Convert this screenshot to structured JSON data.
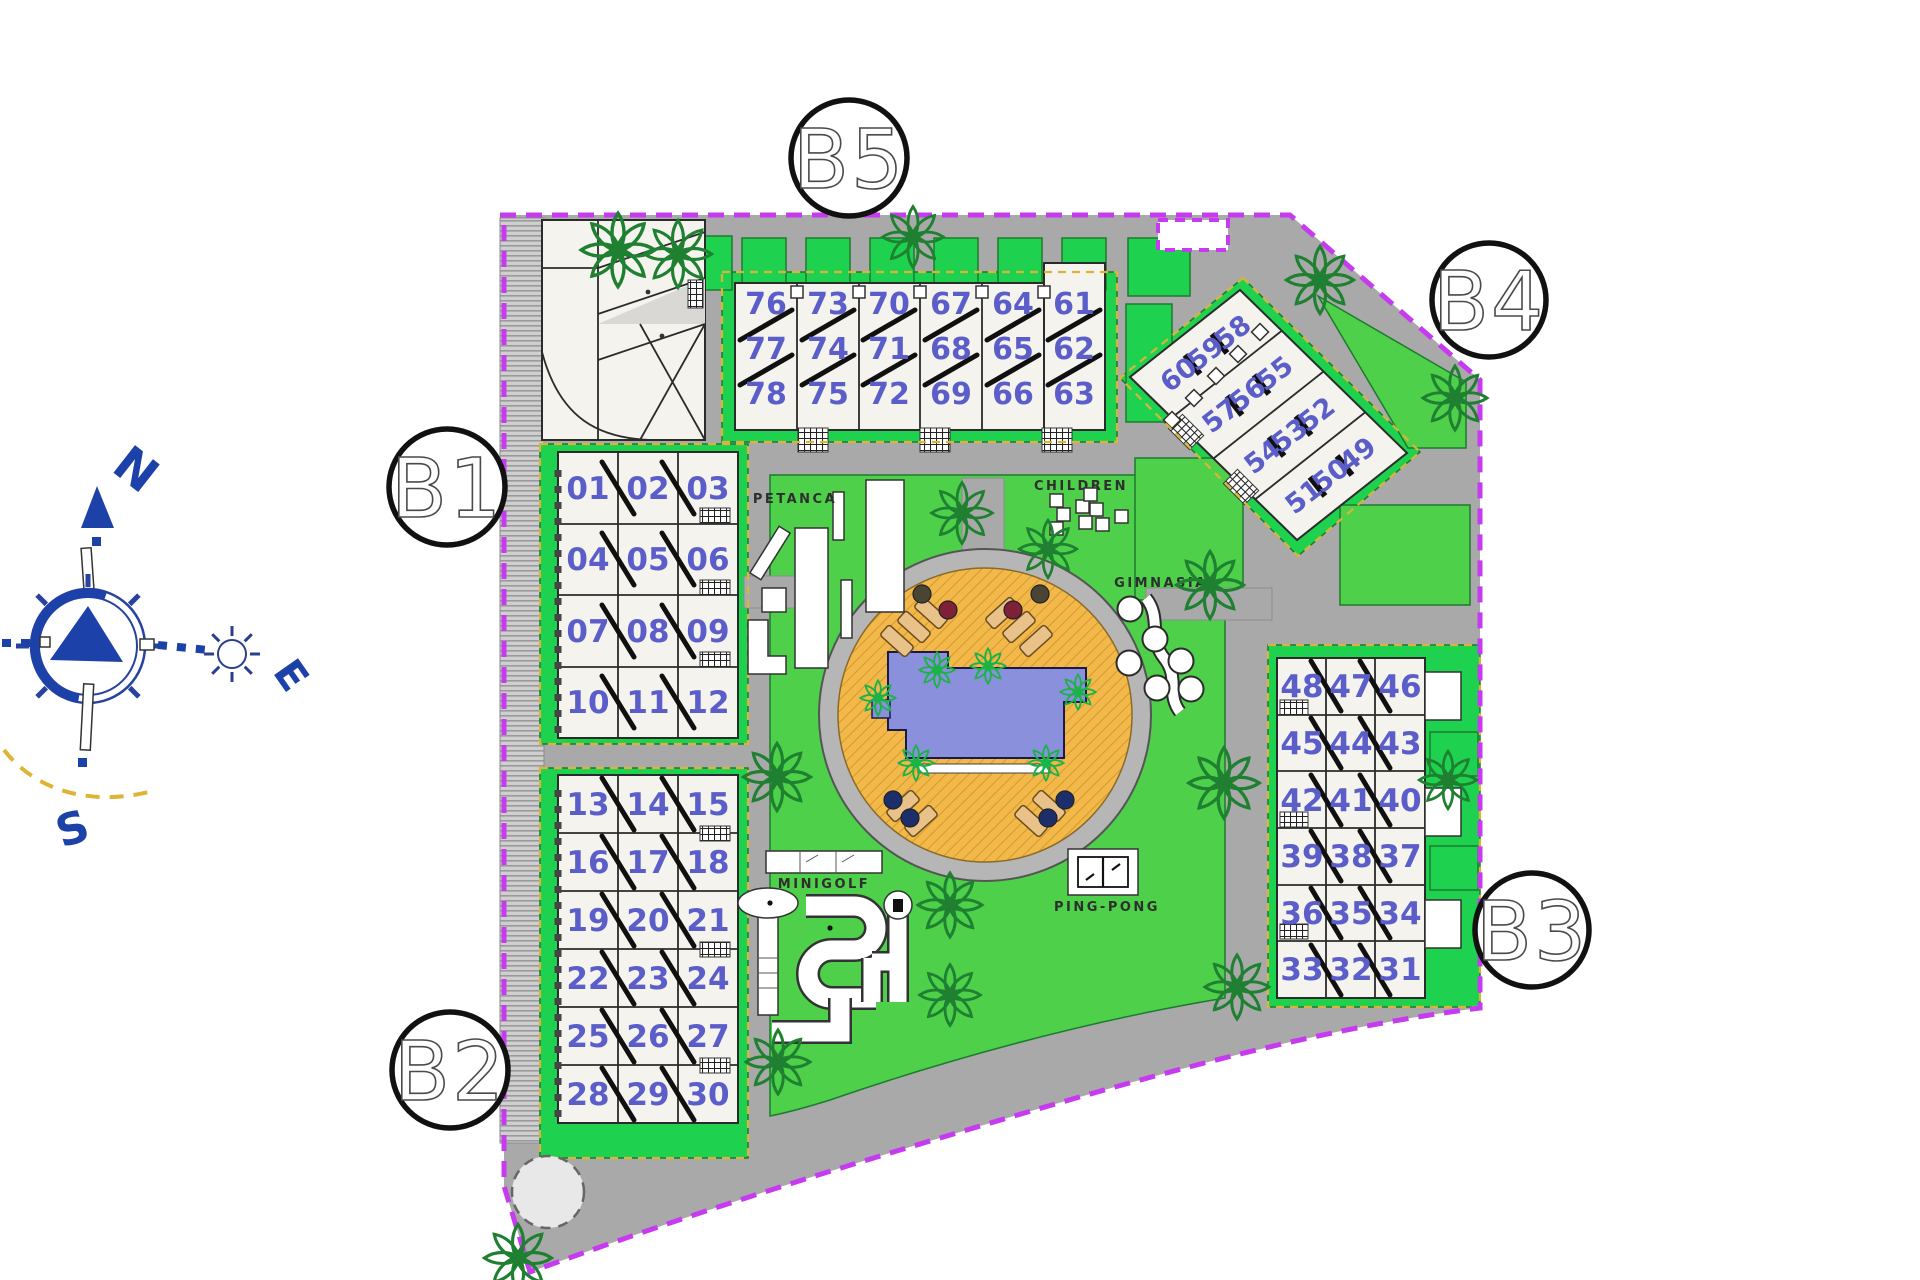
{
  "site": {
    "building_labels": {
      "b1": "B1",
      "b2": "B2",
      "b3": "B3",
      "b4": "B4",
      "b5": "B5"
    },
    "compass": {
      "north": "N",
      "east": "E",
      "south": "S"
    },
    "amenities": {
      "petanca": "PETANCA",
      "children": "CHILDREN",
      "gimnasia": "GIMNASIA",
      "minigolf": "MINIGOLF",
      "pingpong": "PING-PONG"
    },
    "buildings": {
      "b5": {
        "rows": [
          [
            "76",
            "73",
            "70",
            "67",
            "64",
            "61"
          ],
          [
            "77",
            "74",
            "71",
            "68",
            "65",
            "62"
          ],
          [
            "78",
            "75",
            "72",
            "69",
            "66",
            "63"
          ]
        ]
      },
      "b1": {
        "rows": [
          [
            "01",
            "02",
            "03"
          ],
          [
            "04",
            "05",
            "06"
          ],
          [
            "07",
            "08",
            "09"
          ],
          [
            "10",
            "11",
            "12"
          ]
        ]
      },
      "b2": {
        "rows": [
          [
            "13",
            "14",
            "15"
          ],
          [
            "16",
            "17",
            "18"
          ],
          [
            "19",
            "20",
            "21"
          ],
          [
            "22",
            "23",
            "24"
          ],
          [
            "25",
            "26",
            "27"
          ],
          [
            "28",
            "29",
            "30"
          ]
        ]
      },
      "b3": {
        "rows": [
          [
            "48",
            "47",
            "46"
          ],
          [
            "45",
            "44",
            "43"
          ],
          [
            "42",
            "41",
            "40"
          ],
          [
            "39",
            "38",
            "37"
          ],
          [
            "36",
            "35",
            "34"
          ],
          [
            "33",
            "32",
            "31"
          ]
        ]
      },
      "b4": {
        "rows": [
          [
            "60",
            "59",
            "58"
          ],
          [
            "57",
            "56",
            "55"
          ],
          [
            "54",
            "53",
            "52"
          ],
          [
            "51",
            "50",
            "49"
          ]
        ]
      }
    },
    "colors": {
      "boundary": "#c73bf0",
      "lawn": "#4ed04a",
      "lawn_bright": "#1ed24f",
      "road": "#a9a9a9",
      "pool_water": "#8b90dc",
      "pool_deck": "#f2b84a",
      "unit_number": "#5b5ec8",
      "tree": "#1e8030",
      "compass_blue": "#1c41a8",
      "accent_dashed_yellow": "#d9b43a"
    }
  }
}
